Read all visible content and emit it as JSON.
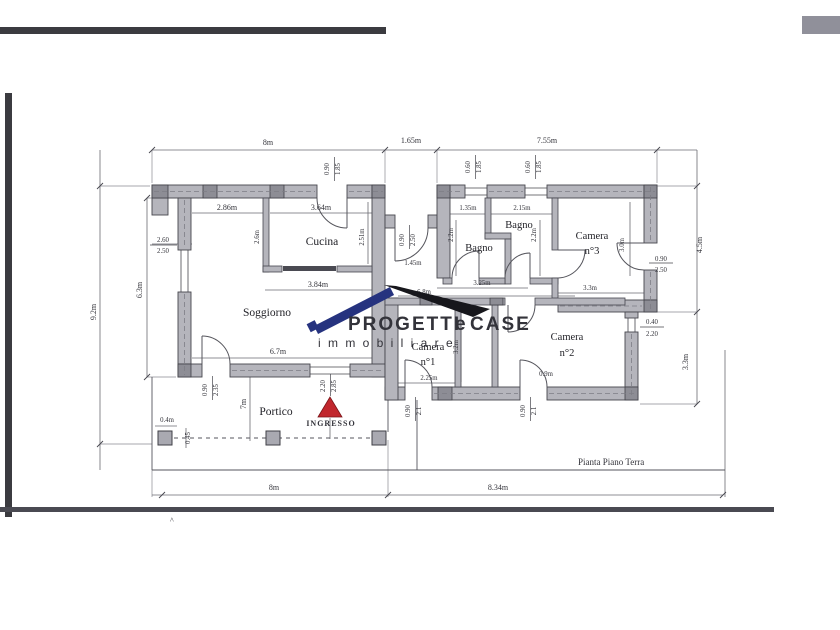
{
  "document": {
    "title": "Pianta Piano Terra",
    "caret": "^"
  },
  "watermark": {
    "brand_1": "PROGETTI",
    "brand_e": "e",
    "brand_2": "CASE",
    "tagline": "i m m o b i l i a r e"
  },
  "rooms": {
    "soggiorno": "Soggiorno",
    "cucina": "Cucina",
    "bagno": "Bagno",
    "camera": "Camera",
    "n1": "n°1",
    "n2": "n°2",
    "n3": "n°3",
    "portico": "Portico",
    "ingresso": "INGRESSO"
  },
  "dims": {
    "m8": "8m",
    "m165": "1.65m",
    "m755": "7.55m",
    "m92": "9.2m",
    "m63": "6.3m",
    "m260": "2.60",
    "m250": "2.50",
    "m090": "0.90",
    "m185": "1.85",
    "m060": "0.60",
    "m286": "2.86m",
    "m364": "3.64m",
    "m26": "2.6m",
    "m251": "2.51m",
    "m384": "3.84m",
    "m67": "6.7m",
    "m235": "2.35",
    "m7": "7m",
    "m04": "0.4m",
    "m045": "0.45",
    "m220": "2.20",
    "m285": "2.85",
    "m21": "2.1",
    "m145": "1.45m",
    "m325": "3.25m",
    "m68": "6.8m",
    "m135": "1.35m",
    "m215": "2.15m",
    "m22": "2.2m",
    "m33": "3.3m",
    "m30": "3.0m",
    "m225": "2.25m",
    "m09": "0.9m",
    "m32": "3.2m",
    "m45": "4.5m",
    "m834": "8.34m",
    "m040": "0.40"
  },
  "colors": {
    "wall": "#b5b5bc",
    "pier": "#8d8d95",
    "line": "#46464e",
    "dim": "#55555c",
    "red": "#c1272d",
    "brand_blue": "#26337f",
    "brand_black": "#17171c",
    "brand_gray": "#3c3c44",
    "brand_light": "#a8a8b0",
    "scan": "#3b3b40"
  }
}
